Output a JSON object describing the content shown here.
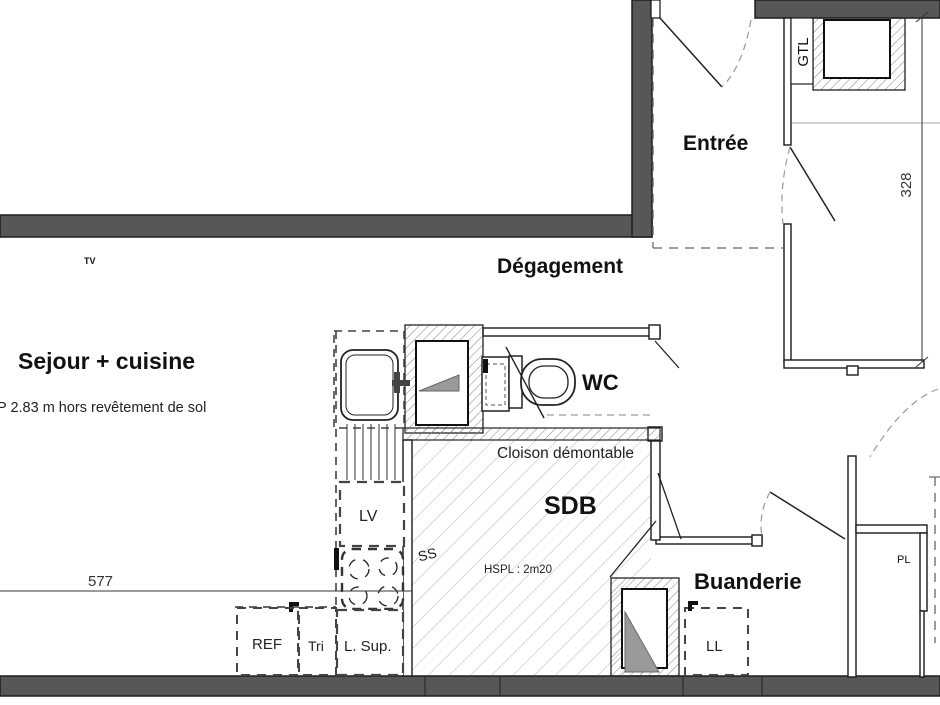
{
  "plan": {
    "rooms": {
      "sejour": {
        "label": "Sejour + cuisine",
        "ceiling_note": "P 2.83 m hors revêtement de sol"
      },
      "degagement": {
        "label": "Dégagement"
      },
      "entree": {
        "label": "Entrée"
      },
      "wc": {
        "label": "WC"
      },
      "sdb": {
        "label": "SDB",
        "height_under_ceiling": "HSPL : 2m20",
        "shower_label": "SS"
      },
      "buanderie": {
        "label": "Buanderie"
      }
    },
    "equipment": {
      "gtl": "GTL",
      "lv": "LV",
      "ref": "REF",
      "tri": "Tri",
      "l_sup": "L. Sup.",
      "ll": "LL",
      "pl": "PL",
      "tv": "TV"
    },
    "notes": {
      "partition": "Cloison démontable"
    },
    "dimensions": {
      "horizontal_cm": "577",
      "vertical_cm": "328"
    },
    "colors": {
      "wall": "#575757",
      "shaft_fill": "#9a9a9a",
      "paper": "#ffffff"
    }
  }
}
